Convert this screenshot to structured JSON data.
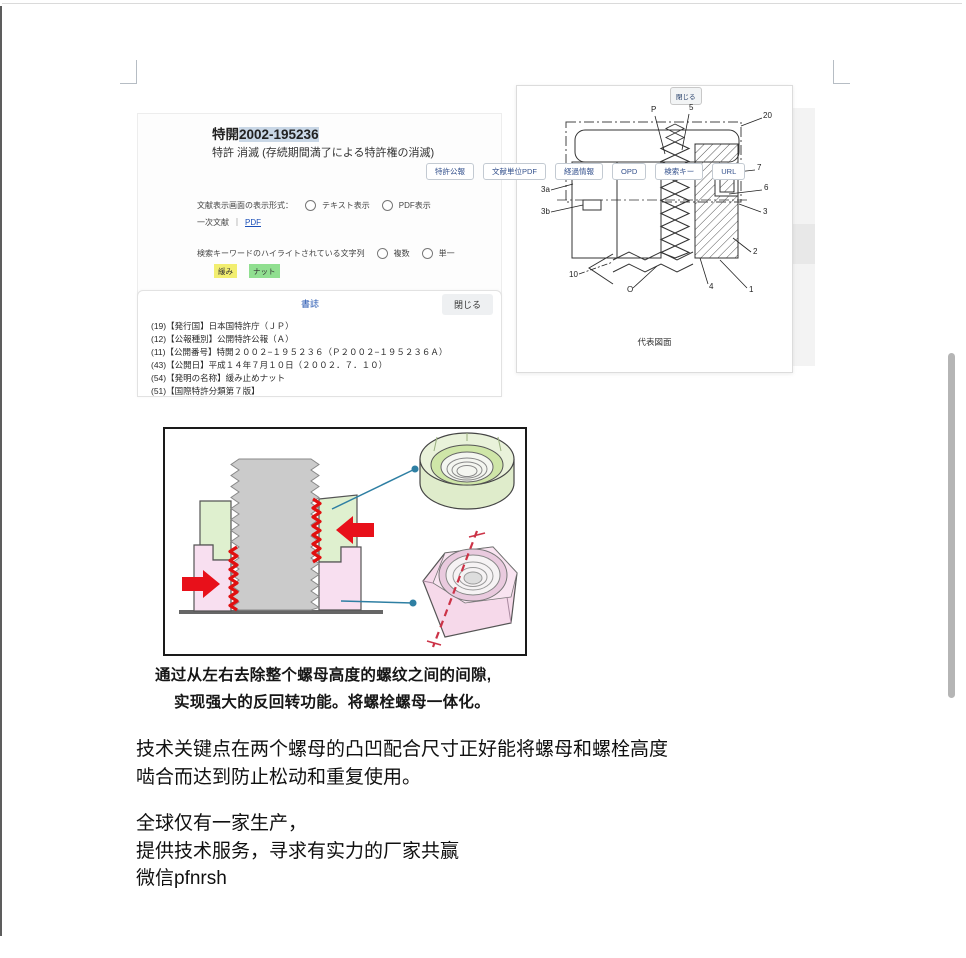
{
  "patent_viewer": {
    "doc_title_prefix": "特開",
    "doc_number": "2002-195236",
    "status_line": "特許 消滅 (存続期間満了による特許権の消滅)",
    "toolbar_buttons": [
      "特許公報",
      "文献単位PDF",
      "経過情報",
      "OPD",
      "検索キー",
      "URL"
    ],
    "display_format_label": "文献表示画面の表示形式：",
    "display_format_options": [
      "テキスト表示",
      "PDF表示"
    ],
    "primary_doc_label": "一次文献",
    "primary_doc_separator": "｜",
    "primary_doc_link": "PDF",
    "highlight_label": "検索キーワードのハイライトされている文字列",
    "highlight_options": [
      "複数",
      "単一"
    ],
    "highlight_chips": [
      {
        "text": "緩み",
        "color": "#f2ee70"
      },
      {
        "text": "ナット",
        "color": "#90df90"
      }
    ],
    "biblio_header_link": "書誌",
    "biblio_close_button": "閉じる",
    "biblio_lines": [
      "(19)【発行国】日本国特許庁（ＪＰ）",
      "(12)【公報種別】公開特許公報（Ａ）",
      "(11)【公開番号】特開２００２−１９５２３６（Ｐ２００２−１９５２３６Ａ）",
      "(43)【公開日】平成１４年７月１０日（２００２．７．１０）",
      "(54)【発明の名称】緩み止めナット",
      "(51)【国際特許分類第７版】"
    ]
  },
  "drawing_panel": {
    "close_button": "閉じる",
    "caption": "代表図面",
    "ref_labels": [
      {
        "t": "P",
        "x": 134,
        "y": 10
      },
      {
        "t": "5",
        "x": 172,
        "y": 8
      },
      {
        "t": "20",
        "x": 246,
        "y": 16
      },
      {
        "t": "7",
        "x": 240,
        "y": 68
      },
      {
        "t": "6",
        "x": 247,
        "y": 88
      },
      {
        "t": "3",
        "x": 246,
        "y": 112
      },
      {
        "t": "2",
        "x": 236,
        "y": 152
      },
      {
        "t": "1",
        "x": 232,
        "y": 190
      },
      {
        "t": "4",
        "x": 192,
        "y": 187
      },
      {
        "t": "O",
        "x": 110,
        "y": 190
      },
      {
        "t": "10",
        "x": 52,
        "y": 175
      },
      {
        "t": "3a",
        "x": 24,
        "y": 90
      },
      {
        "t": "3b",
        "x": 24,
        "y": 112
      }
    ]
  },
  "captions": {
    "line1": "通过从左右去除整个螺母高度的螺纹之间的间隙,",
    "line2": "实现强大的反回转功能。将螺栓螺母一体化。"
  },
  "body_text": {
    "para1_line1": "技术关键点在两个螺母的凸凹配合尺寸正好能将螺母和螺栓高度",
    "para1_line2": "啮合而达到防止松动和重复使用。",
    "para2_line1": "全球仅有一家生产，",
    "para2_line2": "提供技术服务，寻求有实力的厂家共赢",
    "para2_line3": "微信pfnrsh"
  },
  "colors": {
    "title_selection": "#c9d7e6",
    "upper_nut_green": "#dff0cf",
    "lower_nut_pink": "#f8dff0",
    "thread_red": "#e01010",
    "arrow_red": "#e8101a",
    "pointer_blue": "#2e7fa3",
    "scrollbar_gray": "#b5b5b5"
  }
}
